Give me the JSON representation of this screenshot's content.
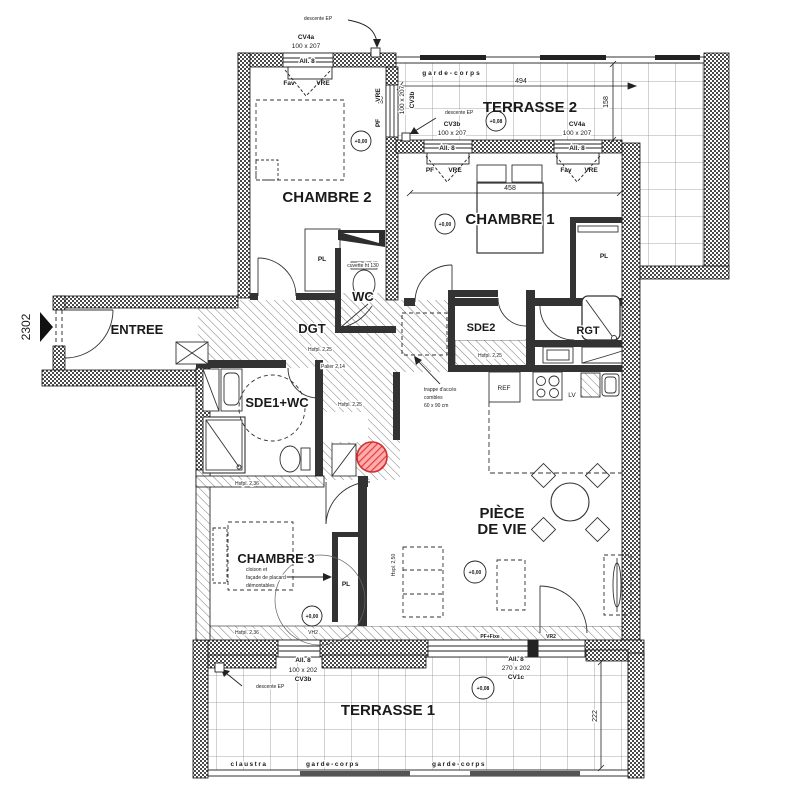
{
  "unit": {
    "number": "2302"
  },
  "rooms": {
    "terrasse2": "TERRASSE 2",
    "chambre1": "CHAMBRE 1",
    "chambre2": "CHAMBRE 2",
    "chambre3": "CHAMBRE 3",
    "wc": "WC",
    "entree": "ENTREE",
    "dgt": "DGT",
    "sde2": "SDE2",
    "rgt": "RGT",
    "sde1wc": "SDE1+WC",
    "pdv_line1": "PIÈCE",
    "pdv_line2": "DE VIE",
    "terrasse1": "TERRASSE 1"
  },
  "levels": {
    "zero": "+0,00",
    "eight": "+0,08"
  },
  "dimensions": {
    "d494": "494",
    "d458": "458",
    "d158": "158",
    "d222": "222",
    "d36": "36"
  },
  "windows": {
    "cv4a": "CV4a",
    "cv3b": "CV3b",
    "cv1c": "CV1c",
    "s100x207": "100 x 207",
    "s100x202": "100 x 202",
    "s270x202": "270 x 202",
    "all8": "All. 8",
    "pf": "PF",
    "vre": "VRE",
    "fav": "Fav",
    "pf_fixe": "PF+Fixe",
    "vr2": "VR2",
    "vh2": "VH2"
  },
  "annotations": {
    "descente_ep": "descente EP",
    "garde_corps": "garde-corps",
    "claustra": "claustra",
    "hsfpl_225": "Hsfpl.  2,25",
    "hsfpl_236": "Hsfpl.  2,36",
    "palier": "Palier  2,14",
    "hspl_250": "Hspl. 2,50",
    "trappe_1": "trappe d'accès",
    "trappe_2": "combles",
    "trappe_3": "60 x 90 cm",
    "cloison_1": "cloison et",
    "cloison_2": "façade de placard",
    "cloison_3": "démontables",
    "pl": "PL",
    "ref": "REF",
    "lv": "LV",
    "cuvette": "cuvette ht 130"
  },
  "marker": {
    "color": "#e03636"
  }
}
